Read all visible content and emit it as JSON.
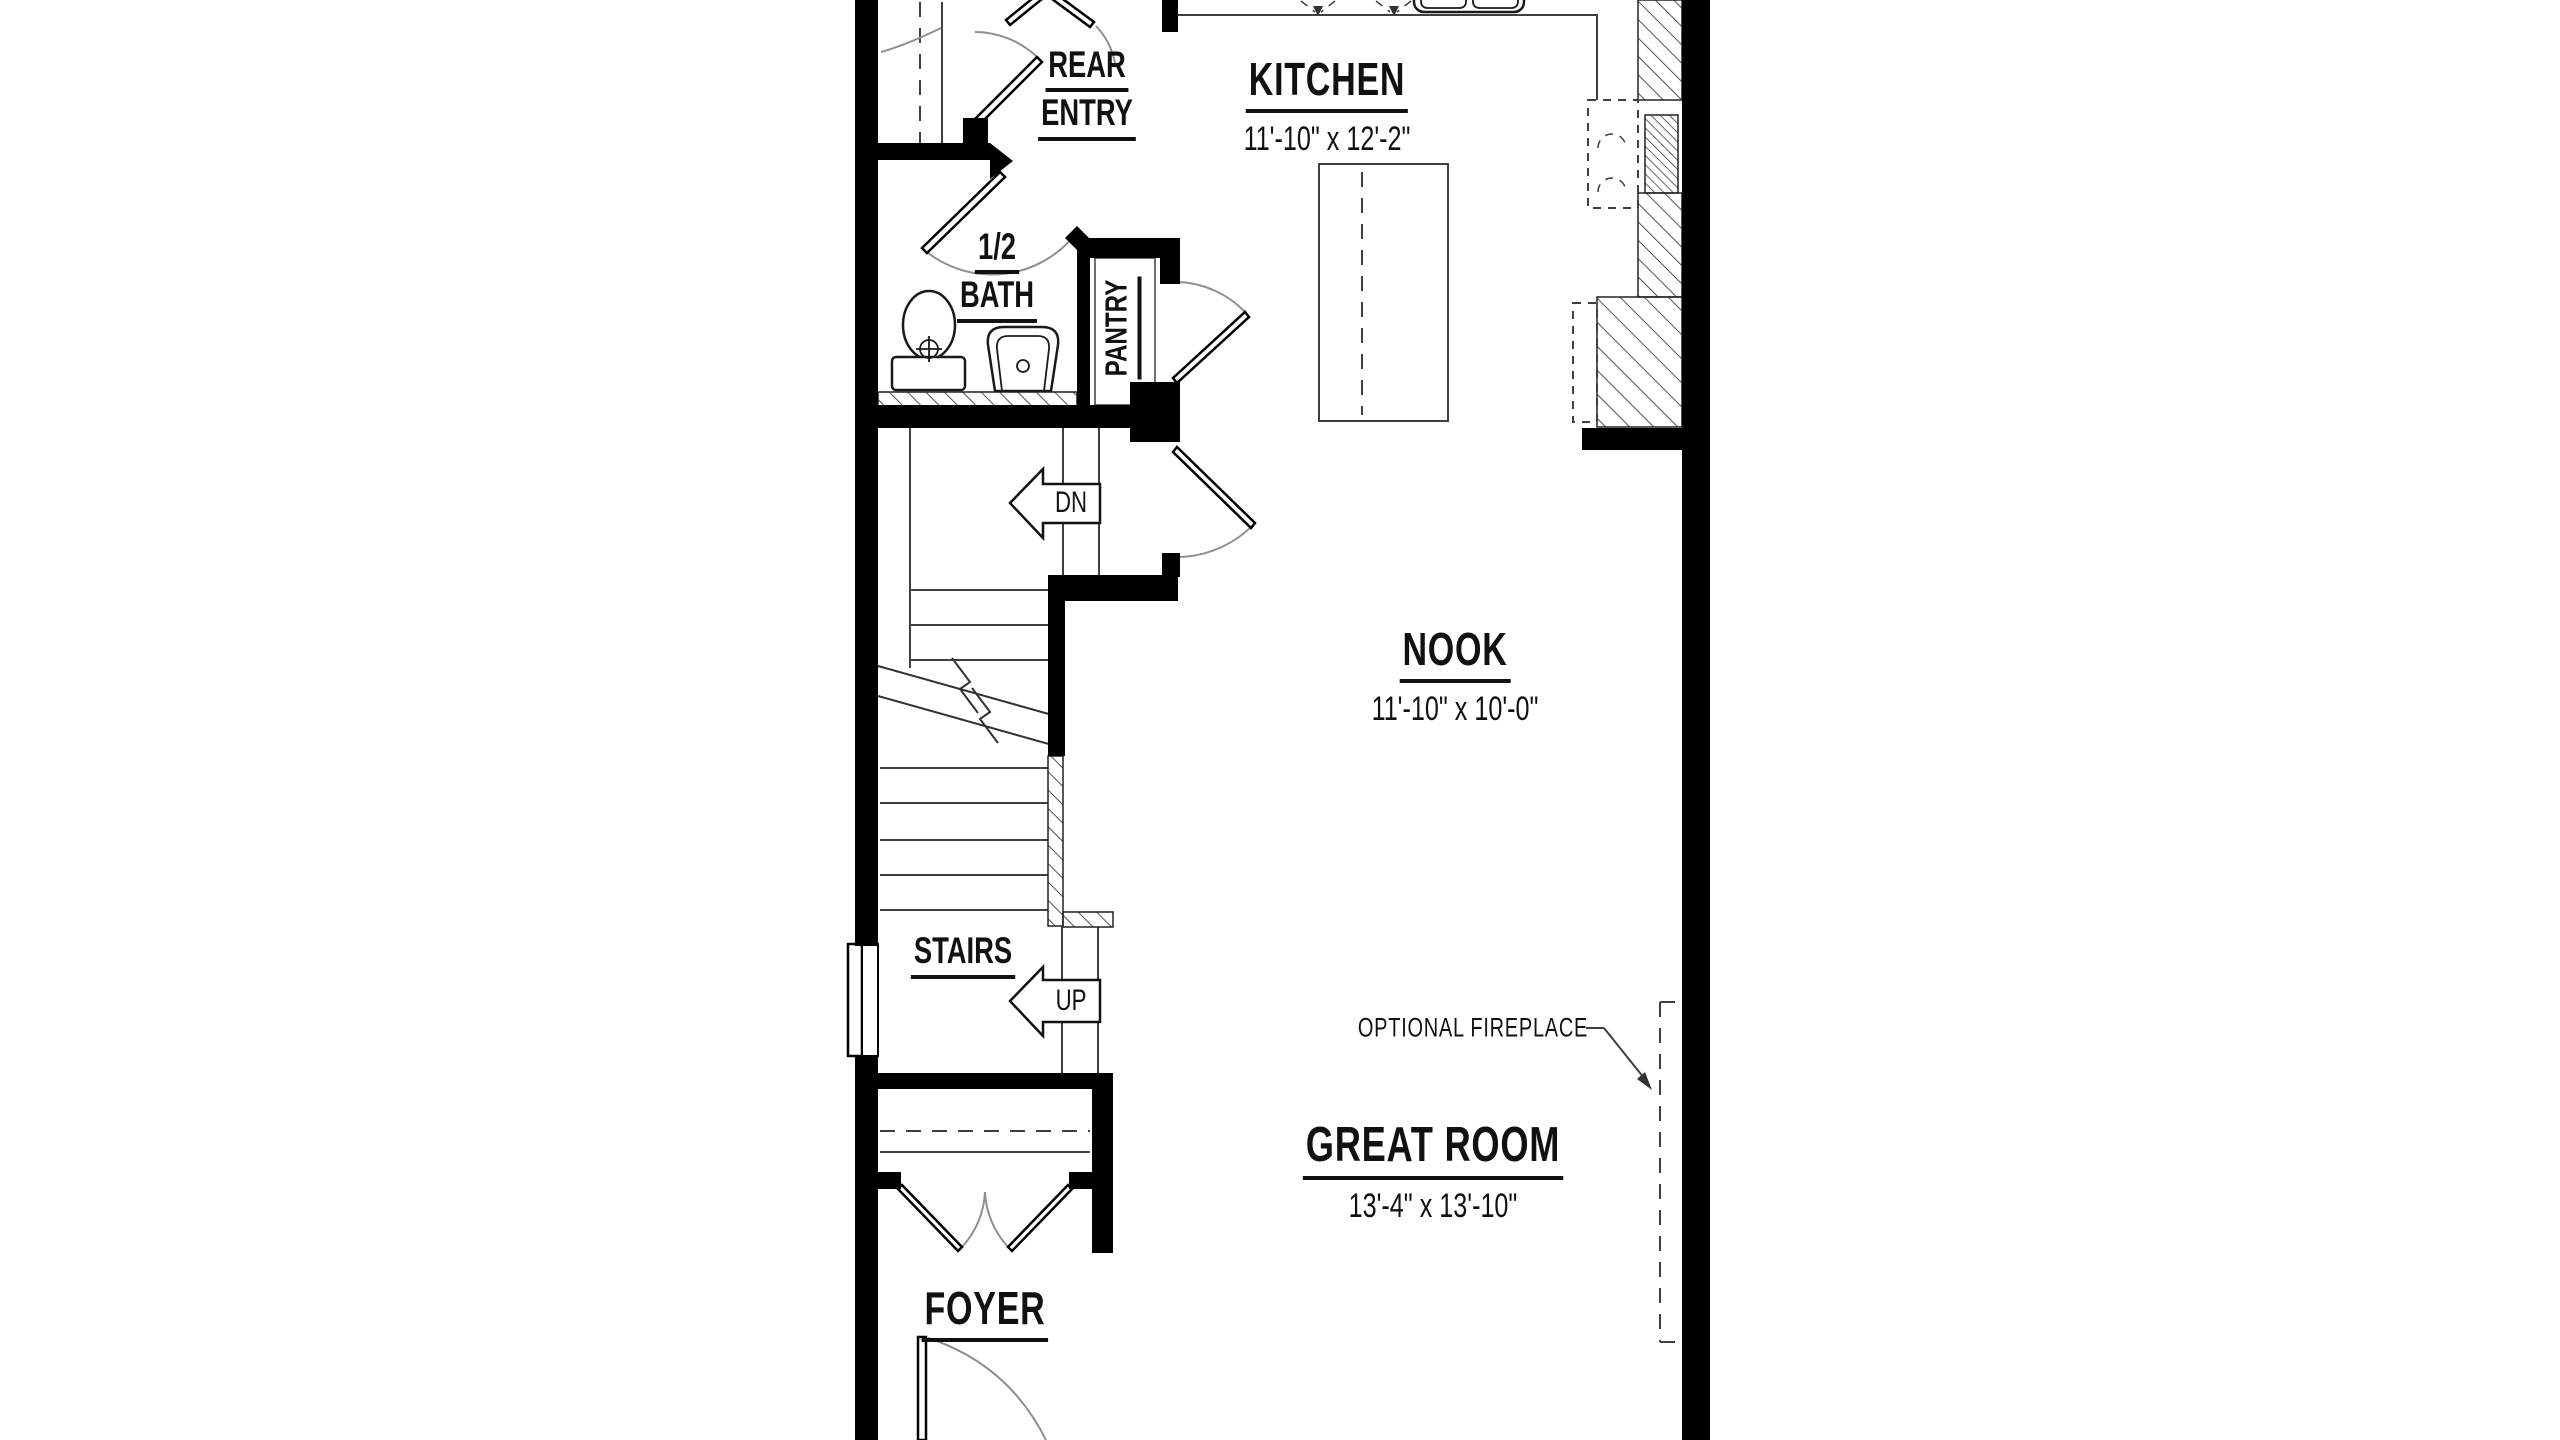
{
  "colors": {
    "wall": "#000000",
    "line": "#3f3f3f",
    "swing": "#8f8f8f",
    "text": "#111111",
    "background": "#ffffff"
  },
  "rooms": {
    "rear_entry": {
      "line1": "REAR",
      "line2": "ENTRY"
    },
    "kitchen": {
      "name": "KITCHEN",
      "dims": "11'-10\" x 12'-2\""
    },
    "half_bath": {
      "line1": "1/2",
      "line2": "BATH"
    },
    "pantry": {
      "name": "PANTRY"
    },
    "nook": {
      "name": "NOOK",
      "dims": "11'-10\" x 10'-0\""
    },
    "stairs": {
      "name": "STAIRS"
    },
    "great_room": {
      "name": "GREAT ROOM",
      "dims": "13'-4\" x 13'-10\""
    },
    "foyer": {
      "name": "FOYER"
    }
  },
  "annotations": {
    "down_arrow": "DN",
    "up_arrow": "UP",
    "fireplace_note": "OPTIONAL FIREPLACE"
  },
  "fixtures": {
    "half_bath": [
      "toilet",
      "pedestal-sink",
      "vanity-counter"
    ],
    "kitchen": [
      "double-sink",
      "kitchen-island",
      "optional-wall-oven",
      "dishwasher",
      "counter-run"
    ],
    "great_room": [
      "optional-fireplace"
    ],
    "stairs": [
      "stair-break-line",
      "railing"
    ],
    "foyer": [
      "coat-closet",
      "front-door"
    ],
    "exterior": [
      "window"
    ]
  }
}
